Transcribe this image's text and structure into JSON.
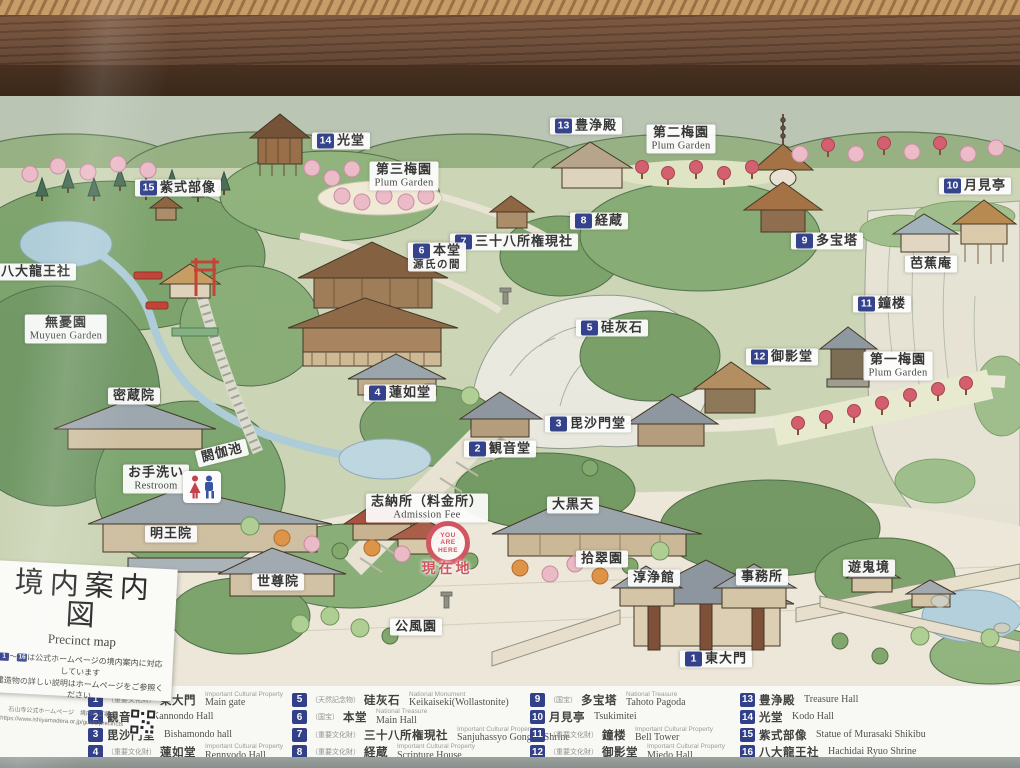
{
  "colors": {
    "badge_navy": "#2b3a88",
    "marker_red": "#d2505c",
    "wood_dark": "#3b2313",
    "wood_mid": "#63402a",
    "wood_light": "#b98a55",
    "label_bg": "#ffffff",
    "legend_bg": "#fcfcf7"
  },
  "title_panel": {
    "title_ja": "境内案内図",
    "title_en": "Precinct map",
    "note_badge_start": "1",
    "note_tilde": "～",
    "note_badge_end": "16",
    "note_text": "は公式ホームページの境内案内に対応しています",
    "note_line2": "建造物の詳しい説明はホームページをご参照ください",
    "footer_ja": "石山寺公式ホームページ　境内のご案内",
    "footer_url": "https://www.ishiyamadera.or.jp/guide/precincts"
  },
  "map": {
    "you_are_here": {
      "l1": "YOU",
      "l2": "ARE",
      "l3": "HERE",
      "label_ja": "現在地",
      "x": 448,
      "y": 543,
      "label_x": 447,
      "label_y": 568
    },
    "restroom_icon": {
      "x": 202,
      "y": 487
    },
    "labels": [
      {
        "id": "kodo",
        "num": "14",
        "ja": "光堂",
        "x": 341,
        "y": 141
      },
      {
        "id": "murasaki-statue",
        "num": "15",
        "ja": "紫式部像",
        "x": 178,
        "y": 188
      },
      {
        "id": "hachidai-ryuo",
        "num": "16",
        "ja": "八大龍王社",
        "x": 26,
        "y": 272
      },
      {
        "id": "hojoden",
        "num": "13",
        "ja": "豊浄殿",
        "x": 586,
        "y": 126
      },
      {
        "id": "plum-garden-2",
        "ja": "第二梅園",
        "en": "Plum Garden",
        "x": 681,
        "y": 139
      },
      {
        "id": "plum-garden-3",
        "ja": "第三梅園",
        "en": "Plum Garden",
        "x": 404,
        "y": 176
      },
      {
        "id": "tsukimitei",
        "num": "10",
        "ja": "月見亭",
        "x": 975,
        "y": 186
      },
      {
        "id": "tahoto",
        "num": "9",
        "ja": "多宝塔",
        "x": 827,
        "y": 241
      },
      {
        "id": "bashoan",
        "ja": "芭蕉庵",
        "x": 931,
        "y": 264
      },
      {
        "id": "shoro",
        "num": "11",
        "ja": "鐘楼",
        "x": 882,
        "y": 304
      },
      {
        "id": "kyozo",
        "num": "8",
        "ja": "経蔵",
        "x": 599,
        "y": 221
      },
      {
        "id": "sanjuhassho",
        "num": "7",
        "ja": "三十八所権現社",
        "x": 514,
        "y": 242
      },
      {
        "id": "hondo",
        "num": "6",
        "ja": "本堂",
        "sub": "源氏の間",
        "x": 437,
        "y": 257
      },
      {
        "id": "keikaiseki",
        "num": "5",
        "ja": "硅灰石",
        "x": 612,
        "y": 328
      },
      {
        "id": "miedo",
        "num": "12",
        "ja": "御影堂",
        "x": 782,
        "y": 357
      },
      {
        "id": "plum-garden-1",
        "ja": "第一梅園",
        "en": "Plum Garden",
        "x": 898,
        "y": 366
      },
      {
        "id": "rennyodo",
        "num": "4",
        "ja": "蓮如堂",
        "x": 400,
        "y": 393
      },
      {
        "id": "kannondo",
        "num": "2",
        "ja": "観音堂",
        "x": 500,
        "y": 449
      },
      {
        "id": "bishamondo",
        "num": "3",
        "ja": "毘沙門堂",
        "x": 588,
        "y": 424
      },
      {
        "id": "muyuen-garden",
        "ja": "無憂園",
        "en": "Muyuen Garden",
        "x": 66,
        "y": 329
      },
      {
        "id": "mitsuzoin",
        "ja": "密蔵院",
        "x": 134,
        "y": 396
      },
      {
        "id": "akaike",
        "ja": "閼伽池",
        "x": 222,
        "y": 453,
        "rot": -14
      },
      {
        "id": "otearai",
        "ja": "お手洗い",
        "en": "Restroom",
        "x": 156,
        "y": 479
      },
      {
        "id": "myooin",
        "ja": "明王院",
        "x": 171,
        "y": 534
      },
      {
        "id": "sesonin",
        "ja": "世尊院",
        "x": 278,
        "y": 582
      },
      {
        "id": "kofuen",
        "ja": "公風園",
        "x": 416,
        "y": 627
      },
      {
        "id": "shinosho",
        "ja": "志納所（料金所）",
        "en": "Admission Fee",
        "x": 427,
        "y": 508
      },
      {
        "id": "daikokuten",
        "ja": "大黒天",
        "x": 573,
        "y": 505
      },
      {
        "id": "shusuien",
        "ja": "拾翠園",
        "x": 602,
        "y": 559
      },
      {
        "id": "junjokan",
        "ja": "淳浄館",
        "x": 654,
        "y": 578
      },
      {
        "id": "jimusho",
        "ja": "事務所",
        "x": 762,
        "y": 577
      },
      {
        "id": "yukikyo",
        "ja": "遊鬼境",
        "x": 869,
        "y": 568
      },
      {
        "id": "todaimon",
        "num": "1",
        "ja": "東大門",
        "x": 716,
        "y": 659
      }
    ]
  },
  "legend": {
    "columns": [
      [
        {
          "num": "1",
          "tag": "（重要文化財）",
          "ja": "東大門",
          "en_tag": "Important Cultural Property",
          "en": "Main gate"
        },
        {
          "num": "2",
          "ja": "観音堂",
          "en": "Kannondo Hall"
        },
        {
          "num": "3",
          "ja": "毘沙門堂",
          "en": "Bishamondo hall"
        },
        {
          "num": "4",
          "tag": "（重要文化財）",
          "ja": "蓮如堂",
          "en_tag": "Important Cultural Property",
          "en": "Rennyodo Hall"
        }
      ],
      [
        {
          "num": "5",
          "tag": "（天然記念物）",
          "ja": "硅灰石",
          "en_tag": "National Monument",
          "en": "Keikaiseki(Wollastonite)"
        },
        {
          "num": "6",
          "tag": "（国宝）",
          "ja": "本堂",
          "en_tag": "National Treasure",
          "en": "Main Hall"
        },
        {
          "num": "7",
          "tag": "（重要文化財）",
          "ja": "三十八所権現社",
          "en_tag": "Important Cultural Property",
          "en": "Sanjuhassyo Gongen Shrine"
        },
        {
          "num": "8",
          "tag": "（重要文化財）",
          "ja": "経蔵",
          "en_tag": "Important Cultural Property",
          "en": "Scripture House"
        }
      ],
      [
        {
          "num": "9",
          "tag": "（国宝）",
          "ja": "多宝塔",
          "en_tag": "National Treasure",
          "en": "Tahoto Pagoda"
        },
        {
          "num": "10",
          "ja": "月見亭",
          "en": "Tsukimitei"
        },
        {
          "num": "11",
          "tag": "（重要文化財）",
          "ja": "鐘楼",
          "en_tag": "Important Cultural Property",
          "en": "Bell Tower"
        },
        {
          "num": "12",
          "tag": "（重要文化財）",
          "ja": "御影堂",
          "en_tag": "Important Cultural Property",
          "en": "Miedo Hall"
        }
      ],
      [
        {
          "num": "13",
          "ja": "豊浄殿",
          "en": "Treasure Hall"
        },
        {
          "num": "14",
          "ja": "光堂",
          "en": "Kodo Hall"
        },
        {
          "num": "15",
          "ja": "紫式部像",
          "en": "Statue of Murasaki Shikibu"
        },
        {
          "num": "16",
          "ja": "八大龍王社",
          "en": "Hachidai Ryuo Shrine"
        }
      ]
    ]
  }
}
